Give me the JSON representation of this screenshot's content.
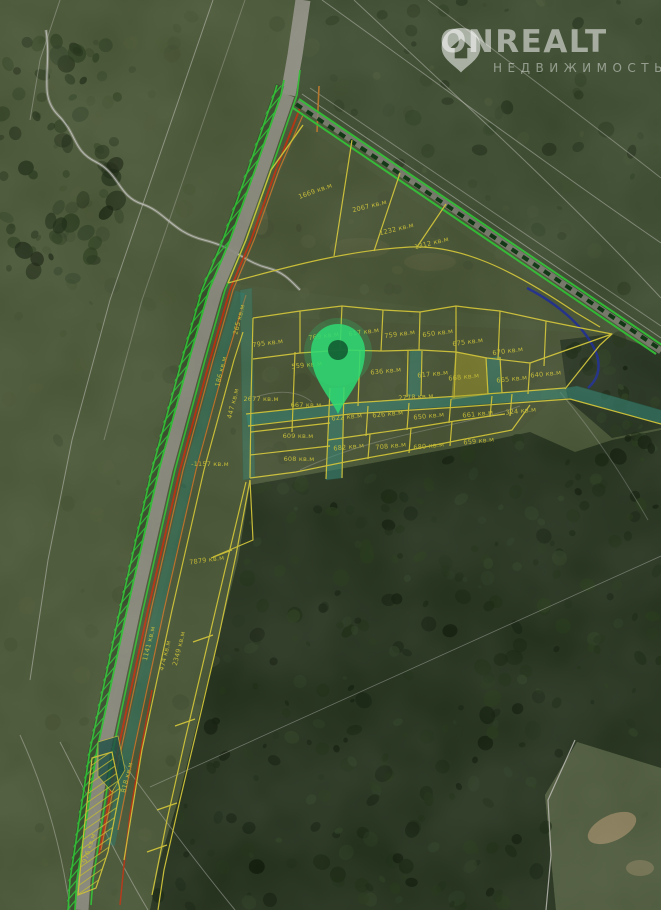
{
  "watermark": {
    "brand": "ONREALT",
    "subtitle": "НЕДВИЖИМОСТЬ"
  },
  "map": {
    "area_unit": "кв.м",
    "selected_parcel_area": "668 кв.м",
    "colors": {
      "parcel_outline": "#f3e53e",
      "road_marking_green": "#35e03a",
      "internal_road_teal": "#3aa390",
      "pin_green": "#2ed973",
      "boundary_red": "#d63a12",
      "utility_orange": "#e0862f",
      "water_blue": "#1d2fae",
      "contour_white": "#e8e8e0"
    },
    "labels": [
      {
        "text": "1669 кв.м",
        "x": 316,
        "y": 193,
        "r": -20
      },
      {
        "text": "2067 кв.м",
        "x": 370,
        "y": 208,
        "r": -14
      },
      {
        "text": "1232 кв.м",
        "x": 397,
        "y": 231,
        "r": -14
      },
      {
        "text": "1312 кв.м",
        "x": 432,
        "y": 245,
        "r": -14
      },
      {
        "text": "795 кв.м",
        "x": 268,
        "y": 345,
        "r": -8
      },
      {
        "text": "769 кв.м",
        "x": 324,
        "y": 338,
        "r": -8
      },
      {
        "text": "617 кв.м",
        "x": 364,
        "y": 334,
        "r": -8
      },
      {
        "text": "759 кв.м",
        "x": 400,
        "y": 336,
        "r": -8
      },
      {
        "text": "650 кв.м",
        "x": 438,
        "y": 335,
        "r": -8
      },
      {
        "text": "675 кв.м",
        "x": 468,
        "y": 344,
        "r": -8
      },
      {
        "text": "670 кв.м",
        "x": 508,
        "y": 353,
        "r": -8
      },
      {
        "text": "559 кв.м",
        "x": 307,
        "y": 367,
        "r": -6
      },
      {
        "text": "636 кв.м",
        "x": 386,
        "y": 373,
        "r": -6
      },
      {
        "text": "617 кв.м",
        "x": 433,
        "y": 376,
        "r": -6
      },
      {
        "text": "668 кв.м",
        "x": 464,
        "y": 379,
        "r": -6
      },
      {
        "text": "665 кв.м",
        "x": 512,
        "y": 381,
        "r": -6
      },
      {
        "text": "640 кв.м",
        "x": 546,
        "y": 376,
        "r": -6
      },
      {
        "text": "2677 кв.м",
        "x": 261,
        "y": 401,
        "r": 0
      },
      {
        "text": "667 кв.м",
        "x": 306,
        "y": 407,
        "r": 0
      },
      {
        "text": "2778 кв.м",
        "x": 416,
        "y": 399,
        "r": -4
      },
      {
        "text": "622 кв.м",
        "x": 347,
        "y": 419,
        "r": -6
      },
      {
        "text": "626 кв.м",
        "x": 388,
        "y": 416,
        "r": -6
      },
      {
        "text": "650 кв.м",
        "x": 429,
        "y": 418,
        "r": -6
      },
      {
        "text": "661 кв.м",
        "x": 478,
        "y": 416,
        "r": -6
      },
      {
        "text": "324 кв.м",
        "x": 521,
        "y": 413,
        "r": -6
      },
      {
        "text": "609 кв.м",
        "x": 298,
        "y": 438,
        "r": 0
      },
      {
        "text": "682 кв.м",
        "x": 349,
        "y": 449,
        "r": -6
      },
      {
        "text": "708 кв.м",
        "x": 391,
        "y": 448,
        "r": -6
      },
      {
        "text": "680 кв.м",
        "x": 429,
        "y": 448,
        "r": -6
      },
      {
        "text": "659 кв.м",
        "x": 479,
        "y": 443,
        "r": -6
      },
      {
        "text": "608 кв.м",
        "x": 299,
        "y": 461,
        "r": 0
      },
      {
        "text": "186 кв.м",
        "x": 223,
        "y": 372,
        "r": -76,
        "c": "#86e06a"
      },
      {
        "text": "265 кв.м",
        "x": 241,
        "y": 320,
        "r": -76
      },
      {
        "text": "447 кв.м",
        "x": 235,
        "y": 404,
        "r": -76
      },
      {
        "text": "-1157 кв.м",
        "x": 210,
        "y": 466,
        "r": 0,
        "c": "#86e06a"
      },
      {
        "text": "7879 кв.м",
        "x": 207,
        "y": 562,
        "r": -8
      },
      {
        "text": "1141 кв.м",
        "x": 151,
        "y": 644,
        "r": -76
      },
      {
        "text": "2349 кв.м",
        "x": 181,
        "y": 649,
        "r": -76
      },
      {
        "text": "474 кв.м",
        "x": 167,
        "y": 656,
        "r": -76
      },
      {
        "text": "818 кв.м",
        "x": 129,
        "y": 778,
        "r": -76
      },
      {
        "text": "976 кв.м",
        "x": 91,
        "y": 849,
        "r": -72,
        "c": "#86e06a"
      }
    ]
  }
}
